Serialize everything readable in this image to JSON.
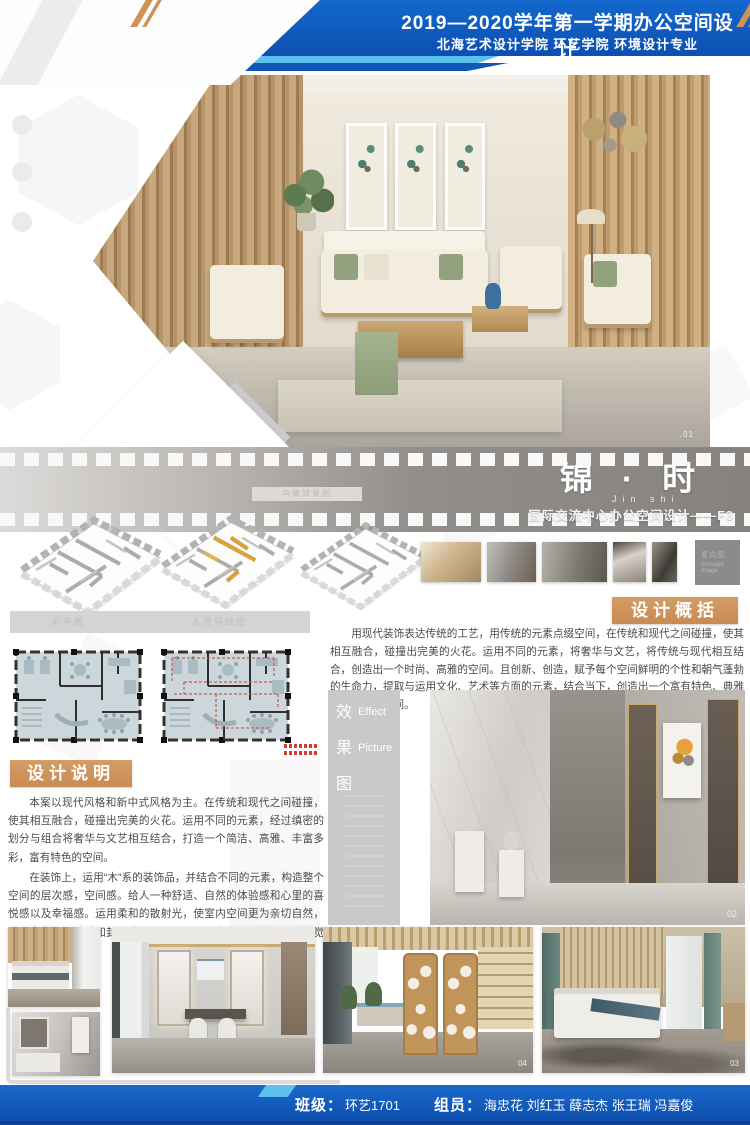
{
  "header": {
    "title": "空间设计大赛",
    "course": "2019—2020学年第一学期办公空间设计",
    "school": "北海艺术设计学院 环艺学院 环境设计专业"
  },
  "title_block": {
    "title": "锦 · 时",
    "pinyin": "Jin  shi",
    "subtitle": "国际交流中心办公空间设计——F3"
  },
  "captions": {
    "axon": "鸟瞰效果图",
    "plan_left": "彩平图",
    "plan_right": "人流导线图",
    "concept_cn": "意向图",
    "concept_en": "Concept Image"
  },
  "overview": {
    "heading": "设计概括",
    "body": "用现代装饰表达传统的工艺，用传统的元素点缀空间，在传统和现代之间碰撞，使其相互融合，碰撞出完美的火花。运用不同的元素，将奢华与文艺，将传统与现代相互结合，创造出一个时尚、高雅的空间。且创新、创造，赋予每个空间鲜明的个性和朝气蓬勃的生命力，提取与运用文化、艺术等方面的元素，结合当下，创造出一个富有特色、典雅及其时尚的空间。"
  },
  "description": {
    "heading": "设计说明",
    "para1": "本案以现代风格和新中式风格为主。在传统和现代之间碰撞，使其相互融合，碰撞出完美的火花。运用不同的元素，经过缜密的划分与组合将奢华与文艺相互结合，打造一个简洁、高雅、丰富多彩，富有特色的空间。",
    "para2": "在装饰上，运用“木”系的装饰品，并结合不同的元素，构造整个空间的层次感，空间感。给人一种舒适、自然的体验感和心里的喜悦感以及幸福感。运用柔和的散射光，使室内空间更为亲切自然，消除室内的黑暗感和封闭感。使室内更加丰富多彩，给人一种视觉上享受。"
  },
  "effect": {
    "cn1": "效",
    "cn2": "果",
    "cn3": "图",
    "en1": "Effect",
    "en2": "Picture"
  },
  "labels": {
    "hero": ".01",
    "effect": "02",
    "gallery_04": "04",
    "gallery_03": "03"
  },
  "footer": {
    "class_label": "班级：",
    "class_value": "环艺1701",
    "members_label": "组员：",
    "members_value": "海忠花 刘红玉 薛志杰 张王瑞 冯嘉俊"
  },
  "colors": {
    "sky_blue": "#5cc1ec",
    "navy_blue": "#0f57bb",
    "tan_accent": "#cd9560",
    "strip_gray": "#8f8b88",
    "footer_blue": "#1160c0"
  }
}
